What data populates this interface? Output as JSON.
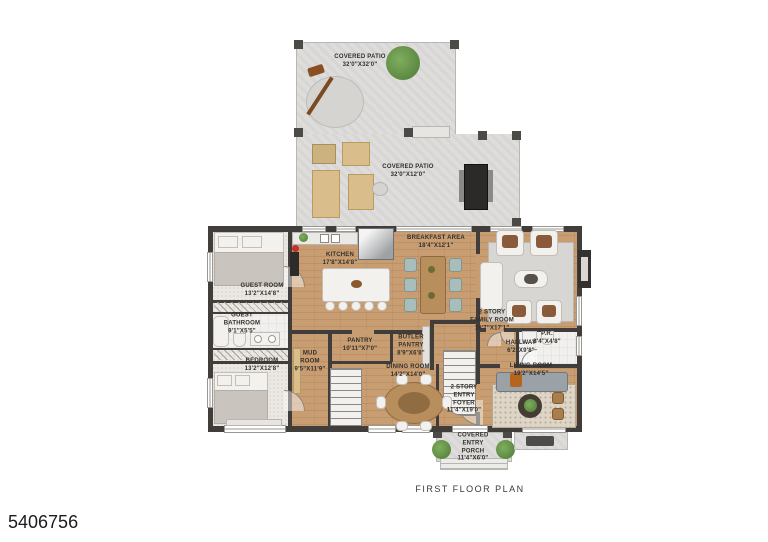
{
  "meta": {
    "plan_title": "FIRST FLOOR PLAN",
    "photo_id": "5406756"
  },
  "colors": {
    "wood_floor": "#c89d72",
    "wall": "#403d3a",
    "patio_stone": "#dedddb",
    "carpet": "#ebe8e3",
    "accent_green": "#5f8f4a",
    "label_text": "#33302c"
  },
  "rooms": {
    "patio_upper": {
      "name": "COVERED PATIO",
      "dims": "32'0\"x32'0\""
    },
    "patio_lower": {
      "name": "COVERED PATIO",
      "dims": "32'0\"x12'0\""
    },
    "kitchen": {
      "name": "KITCHEN",
      "dims": "17'8\"x14'8\""
    },
    "breakfast": {
      "name": "BREAKFAST AREA",
      "dims": "18'4\"x12'1\""
    },
    "family": {
      "name": "2 STORY FAMILY ROOM",
      "dims": "19'7\"x17'1\""
    },
    "guest_room": {
      "name": "GUEST ROOM",
      "dims": "13'2\"x14'8\""
    },
    "guest_bath": {
      "name": "GUEST BATHROOM",
      "dims": "9'1\"x5'5\""
    },
    "bedroom": {
      "name": "BEDROOM",
      "dims": "13'2\"x12'8\""
    },
    "mud_room": {
      "name": "MUD ROOM",
      "dims": "9'5\"x11'9\""
    },
    "pantry": {
      "name": "PANTRY",
      "dims": "10'11\"x7'0\""
    },
    "butler": {
      "name": "BUTLER PANTRY",
      "dims": "8'9\"x6'8\""
    },
    "dining": {
      "name": "DINING ROOM",
      "dims": "14'2\"x14'0\""
    },
    "foyer": {
      "name": "2 STORY ENTRY FOYER",
      "dims": "11'4\"x19'0\""
    },
    "hallway": {
      "name": "HALLWAY",
      "dims": "6'2\"x9'8\""
    },
    "pr": {
      "name": "P.R.",
      "dims": "8'4\"x4'8\""
    },
    "living": {
      "name": "LIVING ROOM",
      "dims": "19'2\"x14'5\""
    },
    "porch": {
      "name": "COVERED ENTRY PORCH",
      "dims": "11'4\"x6'0\""
    }
  }
}
